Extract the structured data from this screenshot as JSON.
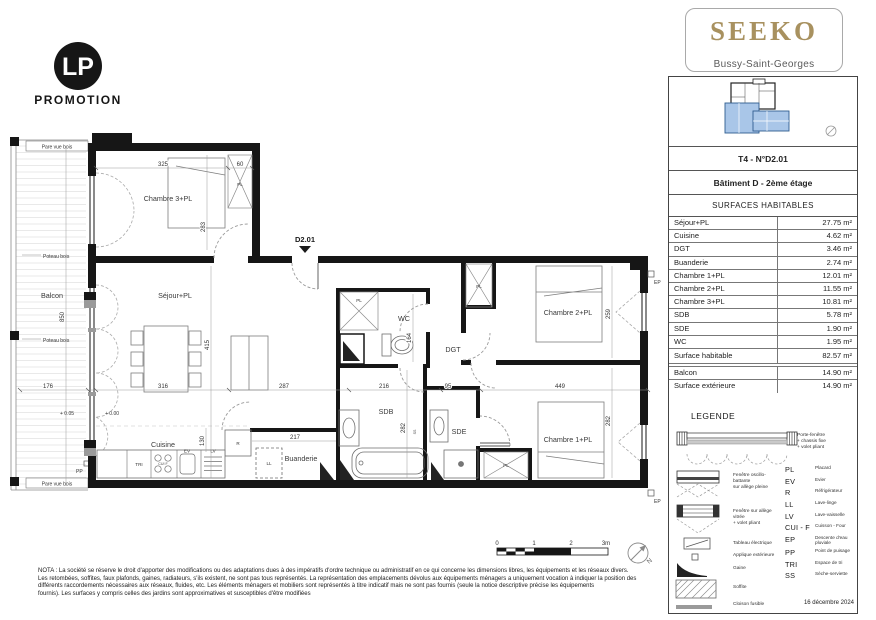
{
  "logo": {
    "monogram": "LP",
    "name": "PROMOTION"
  },
  "brand": {
    "name": "SEEKO",
    "city": "Bussy-Saint-Georges"
  },
  "panel": {
    "unit": "T4 - N°D2.01",
    "building": "Bâtiment D -  2ème étage",
    "surfaces_title": "SURFACES HABITABLES",
    "rows": [
      {
        "label": "Séjour+PL",
        "value": "27.75 m²"
      },
      {
        "label": "Cuisine",
        "value": "4.62 m²"
      },
      {
        "label": "DGT",
        "value": "3.46 m²"
      },
      {
        "label": "Buanderie",
        "value": "2.74 m²"
      },
      {
        "label": "Chambre 1+PL",
        "value": "12.01 m²"
      },
      {
        "label": "Chambre 2+PL",
        "value": "11.55 m²"
      },
      {
        "label": "Chambre 3+PL",
        "value": "10.81 m²"
      },
      {
        "label": "SDB",
        "value": "5.78 m²"
      },
      {
        "label": "SDE",
        "value": "1.90 m²"
      },
      {
        "label": "WC",
        "value": "1.95 m²"
      },
      {
        "label": "Surface habitable",
        "value": "82.57 m²"
      },
      {
        "label": "Balcon",
        "value": "14.90 m²"
      },
      {
        "label": "Surface extérieure",
        "value": "14.90 m²"
      }
    ],
    "date": "16 décembre 2024"
  },
  "legend": {
    "title": "LEGENDE",
    "items": [
      {
        "lines": [
          "Porte-fenêtre",
          "+ chassis fixe",
          "+ volet pliant"
        ]
      },
      {
        "lines": [
          "Fenêtre oscillo-battante",
          "sur allège pleine"
        ]
      },
      {
        "lines": [
          "Fenêtre sur allège vitrée",
          "+ volet pliant"
        ]
      },
      {
        "lines": [
          "Tableau électrique"
        ]
      },
      {
        "lines": [
          "Applique extérieure"
        ]
      },
      {
        "lines": [
          "Gaine"
        ]
      },
      {
        "lines": [
          "Soffite"
        ]
      },
      {
        "lines": [
          "Cloison fusible"
        ]
      }
    ],
    "abbreviations": [
      {
        "abbr": "PL",
        "label": "Placard"
      },
      {
        "abbr": "EV",
        "label": "Evier"
      },
      {
        "abbr": "R",
        "label": "Réfrigérateur"
      },
      {
        "abbr": "LL",
        "label": "Lave-linge"
      },
      {
        "abbr": "LV",
        "label": "Lave-vaisselle"
      },
      {
        "abbr": "CUI - F",
        "label": "Cuisson - Four"
      },
      {
        "abbr": "EP",
        "label": "Descente d'eau pluviale"
      },
      {
        "abbr": "PP",
        "label": "Point de puisage"
      },
      {
        "abbr": "TRI",
        "label": "Espace de tri"
      },
      {
        "abbr": "SS",
        "label": "Sèche-serviette"
      }
    ]
  },
  "plan": {
    "rooms": {
      "chambre3": "Chambre 3+PL",
      "sejour": "Séjour+PL",
      "wc": "WC",
      "dgt": "DGT",
      "chambre2": "Chambre 2+PL",
      "chambre1": "Chambre 1+PL",
      "cuisine": "Cuisine",
      "buanderie": "Buanderie",
      "sdb": "SDB",
      "sde": "SDE",
      "balcon": "Balcon",
      "placard": "PL"
    },
    "dims": {
      "d325": "325",
      "d60": "60",
      "d283": "283",
      "d850": "850",
      "d176": "176",
      "d415": "415",
      "d316": "316",
      "d287": "287",
      "d216": "216",
      "d164": "164",
      "d95": "95",
      "d449": "449",
      "d259": "259",
      "d282": "282",
      "d217": "217",
      "d130": "130"
    },
    "annotations": {
      "unit_door": "D2.01",
      "pare_vue_bois": "Pare vue bois",
      "poteau_bois": "Poteau bois",
      "level_balcony": "+ 0.05",
      "level_floor": "+ 0.00",
      "pp": "PP",
      "ep": "EP",
      "tri": "TRI",
      "ev": "EV",
      "lv": "LV",
      "ll": "LL",
      "r": "R",
      "ss": "SS",
      "cui_f": "CUI F"
    },
    "scalebar": {
      "t0": "0",
      "t1": "1",
      "t2": "2",
      "t3": "3m"
    },
    "north": "N"
  },
  "nota": {
    "lines": [
      "NOTA : La société se réserve le droit d'apporter des modifications ou des adaptations dues à des impératifs d'ordre technique ou administratif en ce qui concerne les dimensions libres, les équipements et les réseaux divers.",
      "Les retombées, soffites, faux plafonds, gaines, radiateurs, s'ils existent, ne sont pas tous représentés. La représentation des emplacements dévolus aux équipements ménagers a uniquement vocation à indiquer la position des",
      "différents raccordements nécessaires aux réseaux, fluides, etc. Les éléments ménagers et mobiliers sont représentés à titre indicatif mais ne sont pas fournis (seule la notice descriptive précise les équipements",
      "fournis). Les surfaces y compris celles des jardins sont approximatives et susceptibles d'être modifiées"
    ]
  }
}
